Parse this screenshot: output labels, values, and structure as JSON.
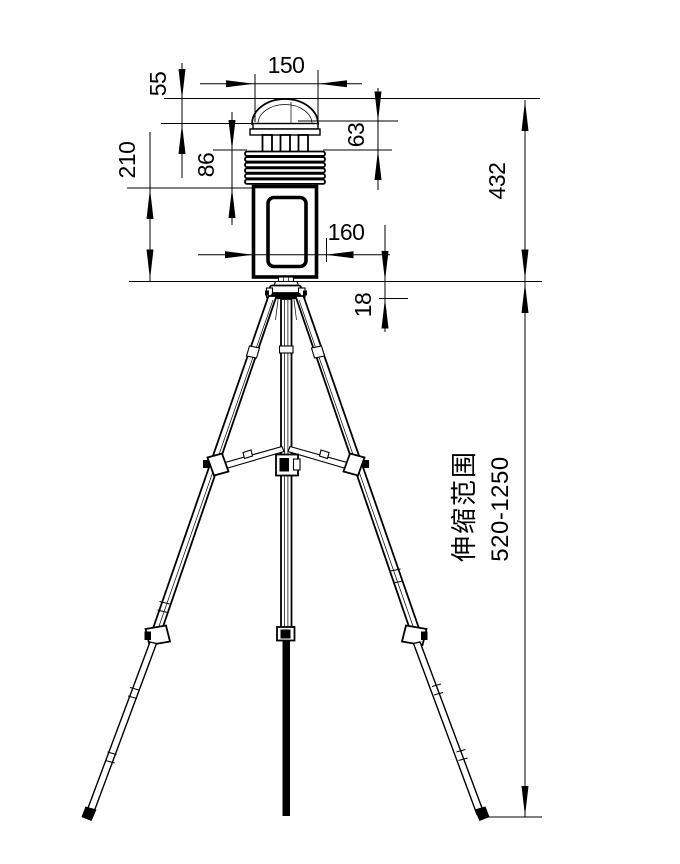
{
  "canvas": {
    "background": "#ffffff",
    "line_color": "#000000"
  },
  "dims": {
    "d150": "150",
    "d55": "55",
    "d63": "63",
    "d86": "86",
    "d210": "210",
    "d160": "160",
    "d18": "18",
    "d432": "432"
  },
  "notes": {
    "telescopic_label": "伸缩范围",
    "telescopic_range": "520-1250"
  }
}
